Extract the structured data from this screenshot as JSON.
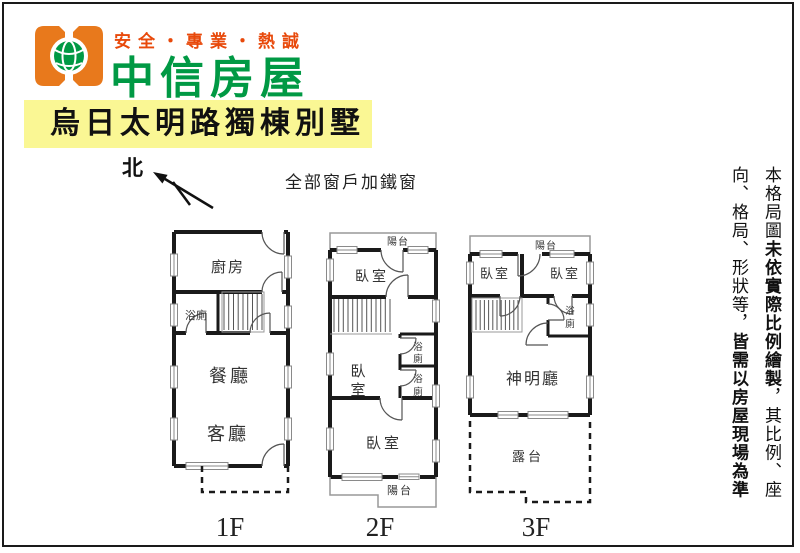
{
  "header": {
    "slogan": "安全・專業・熱誠",
    "brand": "中信房屋",
    "title": "烏日太明路獨棟別墅"
  },
  "compass": {
    "north": "北"
  },
  "note": "全部窗戶加鐵窗",
  "floor1": {
    "label": "1F",
    "kitchen": "廚房",
    "bath": "浴廁",
    "dining": "餐廳",
    "living": "客廳"
  },
  "floor2": {
    "label": "2F",
    "balcony_top": "陽台",
    "bedroom_top": "臥室",
    "bedroom_mid_1": "臥",
    "bedroom_mid_2": "室",
    "bath1_1": "浴",
    "bath1_2": "廁",
    "bath2_1": "浴",
    "bath2_2": "廁",
    "bedroom_bottom": "臥室",
    "balcony_bottom": "陽台"
  },
  "floor3": {
    "label": "3F",
    "balcony": "陽台",
    "bedroom_left": "臥室",
    "bedroom_right": "臥室",
    "bath_1": "浴",
    "bath_2": "廁",
    "shrine": "神明廳",
    "terrace": "露台"
  },
  "disclaimer": {
    "part1": "本格局圖",
    "part2": "未依實際比例繪製",
    "part3": "，其比例、座向、格局、形狀等，",
    "part4": "皆需以房屋現場為準"
  },
  "colors": {
    "brand_orange": "#E8791C",
    "brand_green": "#009944",
    "slogan_orange": "#E8490B",
    "banner_yellow": "#FAF794",
    "wall_black": "#1A1A1A"
  }
}
